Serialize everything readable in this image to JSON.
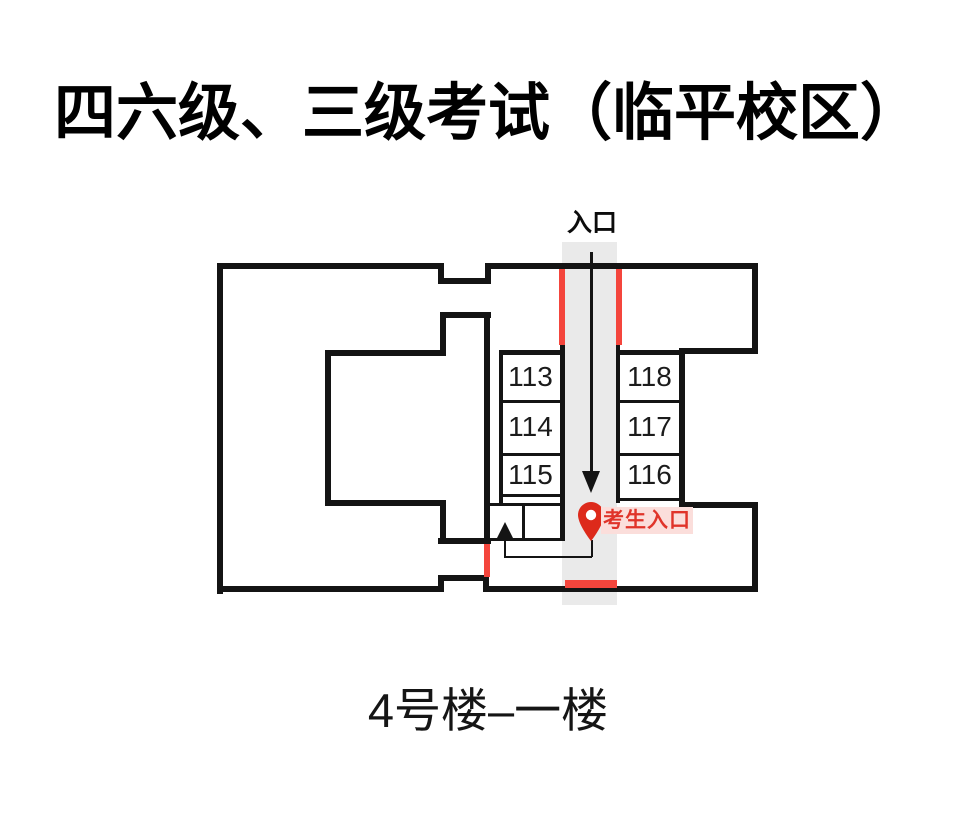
{
  "header": {
    "title": "四六级、三级考试（临平校区）"
  },
  "plan": {
    "entrance_label": "入口",
    "examinee_entrance_label": "考生入口",
    "rooms_left": [
      "113",
      "114",
      "115"
    ],
    "rooms_right": [
      "118",
      "117",
      "116"
    ],
    "icons": [
      "down-arrow-icon",
      "up-arrow-icon",
      "location-pin-icon"
    ]
  },
  "footer": {
    "building_label": "4号楼–一楼"
  },
  "colors": {
    "wall": "#141414",
    "accent_red": "#f4453c",
    "pin_red": "#dd2a1b",
    "pin_label_red": "#e0342a",
    "pin_label_bg": "#fbdedb",
    "corridor_gray": "#eaeaea"
  }
}
